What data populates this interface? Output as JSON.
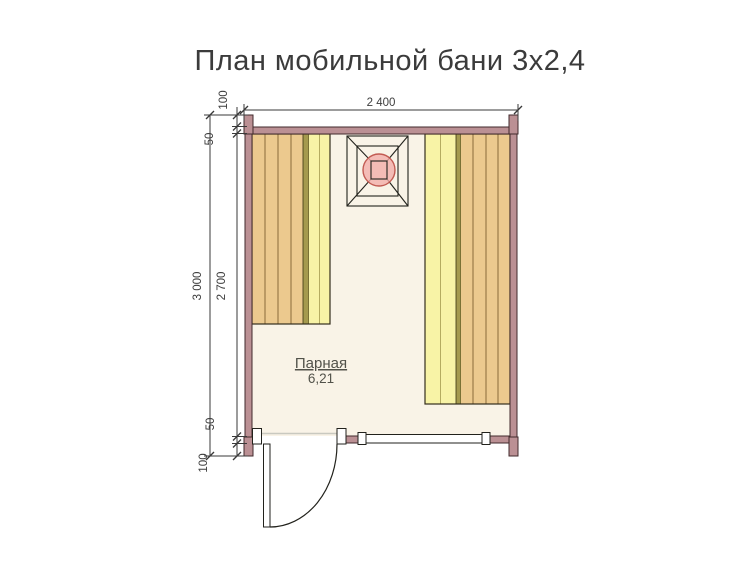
{
  "title": "План мобильной бани 3х2,4",
  "room": {
    "name": "Парная",
    "area": "6,21"
  },
  "dims": {
    "width_total": "2 400",
    "height_total": "3 000",
    "height_inner": "2 700",
    "offset_100_top": "100",
    "offset_50_top": "50",
    "offset_50_bottom": "50",
    "offset_100_bottom": "100"
  },
  "colors": {
    "wall": "#bb9094",
    "wall_outline": "#422a2c",
    "bench_upper": "#ecc98e",
    "bench_upper_line": "#8a6a3a",
    "bench_lower": "#f8f3a6",
    "bench_lower_line": "#b5ac60",
    "bench_separator": "#a59a4e",
    "floor": "#f9f3e7",
    "stove_circle_fill": "#f2aeaa",
    "stove_circle_stroke": "#c25b52",
    "line": "#3a3a3a",
    "text": "#3d3d3d"
  }
}
